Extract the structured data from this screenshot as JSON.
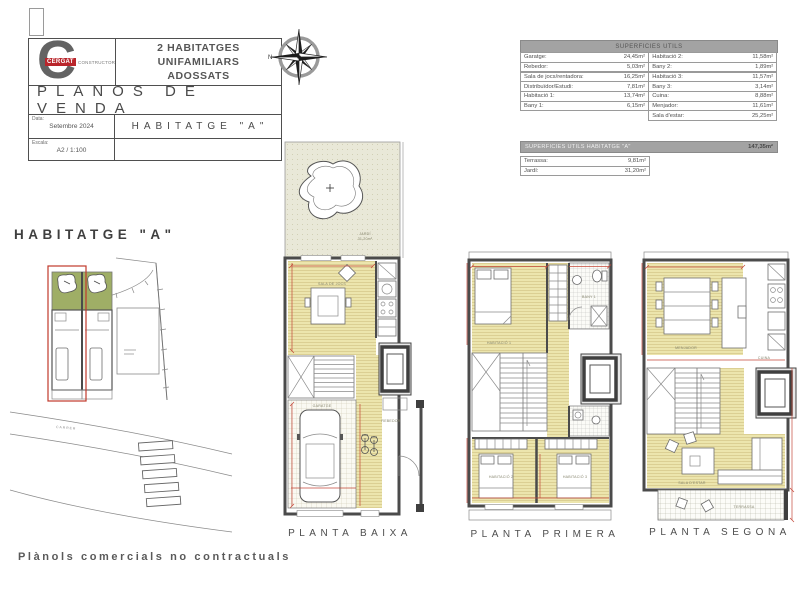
{
  "title_block": {
    "logo_letter": "C",
    "logo_brand": "CERGAT",
    "logo_brand_suffix": "CONSTRUCTORS",
    "project_title_line1": "2 HABITATGES UNIFAMILIARS",
    "project_title_line2": "ADOSSATS",
    "plan_type": "PLANOS DE VENDA",
    "date_label": "Data:",
    "date_value": "Setembre 2024",
    "scale_label": "Escala:",
    "scale_value": "A2 / 1:100",
    "unit_title": "HABITATGE \"A\""
  },
  "compass": {
    "north_label": "N"
  },
  "surfaces_table": {
    "header": "SUPERFICIES UTILS",
    "left_rows": [
      {
        "label": "Garatge:",
        "value": "24,45m²"
      },
      {
        "label": "Rebedor:",
        "value": "5,03m²"
      },
      {
        "label": "Sala de jocs/rentadora:",
        "value": "16,25m²"
      },
      {
        "label": "Distribuïdor/Estudi:",
        "value": "7,81m²"
      },
      {
        "label": "Habitació 1:",
        "value": "13,74m²"
      },
      {
        "label": "Bany 1:",
        "value": "6,15m²"
      }
    ],
    "right_rows": [
      {
        "label": "Habitació 2:",
        "value": "11,58m²"
      },
      {
        "label": "Bany 2:",
        "value": "1,89m²"
      },
      {
        "label": "Habitació 3:",
        "value": "11,57m²"
      },
      {
        "label": "Bany 3:",
        "value": "3,14m²"
      },
      {
        "label": "Cuina:",
        "value": "8,88m²"
      },
      {
        "label": "Menjador:",
        "value": "11,61m²"
      },
      {
        "label": "Sala d'estar:",
        "value": "25,25m²"
      }
    ],
    "total_label": "SUPERFICIES UTILS HABITATGE \"A\"",
    "total_value": "147,35m²",
    "exterior_rows": [
      {
        "label": "Terrassa:",
        "value": "9,81m²"
      },
      {
        "label": "Jardí:",
        "value": "31,20m²"
      }
    ]
  },
  "site_plan": {
    "title": "HABITATGE \"A\"",
    "street_label": "CARRER"
  },
  "floor_plans": [
    {
      "label": "PLANTA BAIXA"
    },
    {
      "label": "PLANTA PRIMERA"
    },
    {
      "label": "PLANTA SEGONA"
    }
  ],
  "plan_annotations": {
    "baixa": {
      "garden": "JARDÍ",
      "garden_area": "31,20m²",
      "sala": "SALA DE JOCS",
      "garatge": "GARATGE",
      "rebedor": "REBEDOR"
    },
    "primera": {
      "hab1": "HABITACIÓ 1",
      "bany1": "BANY 1",
      "hab2": "HABITACIÓ 2",
      "hab3": "HABITACIÓ 3"
    },
    "segona": {
      "menjador": "MENJADOR",
      "cuina": "CUINA",
      "sala_estar": "SALA D'ESTAR",
      "terrassa": "TERRASSA"
    }
  },
  "footer": {
    "disclaimer": "Plànols comercials no contractuals"
  },
  "colors": {
    "accent_red": "#b9252b",
    "dimension_red": "#c4483a",
    "floor_yellow": "#ece5ad",
    "garden_green": "#9fae66",
    "wall_gray": "#4b4b4b",
    "table_header_gray": "#a3a3a3"
  }
}
